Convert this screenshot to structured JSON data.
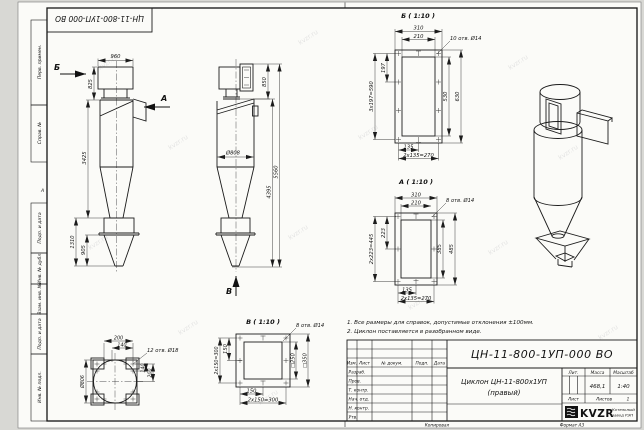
{
  "frame": {
    "corner_number": "ЦН-11-800-1УП-000 ВО",
    "zone_label": "А",
    "margin_labels": [
      "Перв. примен.",
      "Справ. №",
      "Подп. и дата",
      "Инв. № дубл.",
      "Взам. инв. №",
      "Подп. и дата",
      "Инв. № подл."
    ],
    "copy_label": "Копировал",
    "format_label": "Формат А3"
  },
  "watermark": {
    "text": "kvzr.ru"
  },
  "views": {
    "side": {
      "arrow_b": "Б",
      "arrow_a": "А",
      "dim_width": "960",
      "dim_top": "825",
      "dim_body": "3425",
      "dim_bin": "1310",
      "dim_cone": "905"
    },
    "front": {
      "arrow_v": "В",
      "diameter": "Ø808",
      "dim_outlet": "850",
      "dim_inner": "4395",
      "dim_total": "5560"
    },
    "section_b": {
      "title": "Б ( 1:10 )",
      "holes": "10 отв. Ø14",
      "dim_310": "310",
      "dim_210": "210",
      "dim_197": "197",
      "dim_590": "3х197=590",
      "dim_530": "530",
      "dim_630": "630",
      "dim_135": "135",
      "dim_270": "2х135=270"
    },
    "section_a": {
      "title": "А ( 1:10 )",
      "holes": "8 отв. Ø14",
      "dim_310": "310",
      "dim_210": "210",
      "dim_223": "223",
      "dim_445": "2х223=445",
      "dim_385": "385",
      "dim_485": "485",
      "dim_135": "135",
      "dim_270": "2х135=270"
    },
    "section_v": {
      "title": "В ( 1:10 )",
      "holes": "8 отв. Ø14",
      "dim_150_left": "150",
      "dim_300_left": "2х150=300",
      "dim_250": "□250",
      "dim_350": "□350",
      "dim_150_bottom": "150",
      "dim_300_bottom": "2х150=300"
    },
    "flange_bottom": {
      "dim_200_top": "200",
      "dim_140_top": "140",
      "holes": "12 отв. Ø18",
      "dim_140_right": "140",
      "dim_200_right": "200",
      "diameter": "Ø806"
    }
  },
  "notes": {
    "line1": "1. Все размеры для справок, допустимые отклонения ±100мм.",
    "line2": "2. Циклон поставляется в разобранном виде."
  },
  "titleblock": {
    "doc_number": "ЦН-11-800-1УП-000 ВО",
    "title_line1": "Циклон ЦН-11-800х1УП",
    "title_line2": "(правый)",
    "col_izm": "Изм.",
    "col_list": "Лист",
    "col_doc": "№ докум.",
    "col_podp": "Подп.",
    "col_data": "Дата",
    "row_razrab": "Разраб.",
    "row_prov": "Пров.",
    "row_tkontr": "Т. контр.",
    "row_nachotd": "Нач. отд.",
    "row_nkontr": "Н. контр.",
    "row_utv": "Утв.",
    "lit_label": "Лит.",
    "mass_label": "Масса",
    "scale_label": "Масштаб",
    "mass_value": "468,1",
    "scale_value": "1:40",
    "sheet_label": "Лист",
    "sheets_label": "Листов",
    "sheets_value": "1",
    "logo_text": "KVZR",
    "company_line1": "Котельный",
    "company_line2": "завод РЭП"
  }
}
